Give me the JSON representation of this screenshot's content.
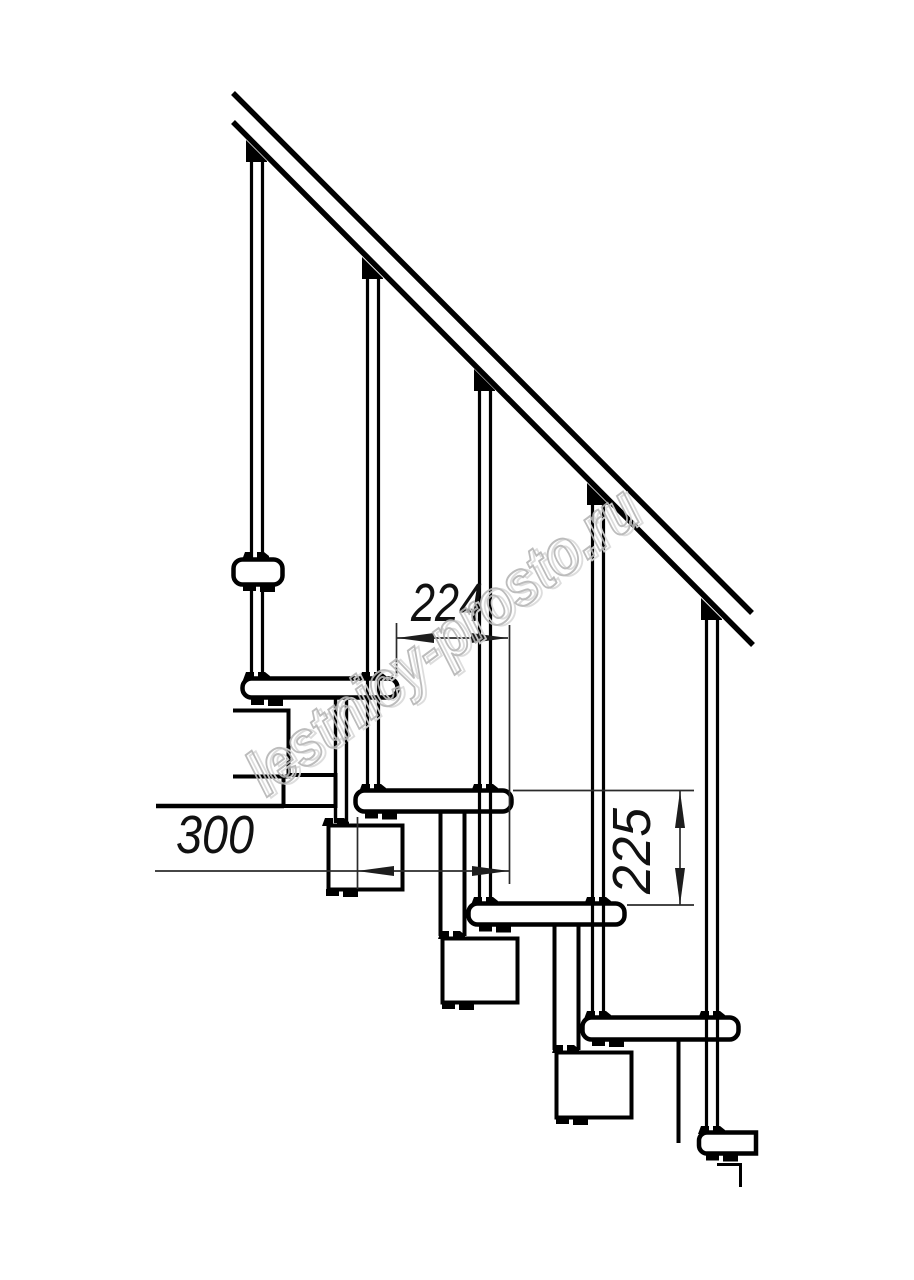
{
  "drawing": {
    "dimensions": {
      "step_run": {
        "value": "224"
      },
      "tread_depth": {
        "value": "300"
      },
      "riser_height": {
        "value": "225"
      }
    },
    "watermark": {
      "text": "lestnicy-prosto.ru",
      "color": "#b5b5b5"
    },
    "style": {
      "line_color": "#000000",
      "dimension_line_color": "#2b2b2b",
      "background": "#ffffff"
    },
    "structure": {
      "balusters": 5,
      "treads": 5
    }
  }
}
